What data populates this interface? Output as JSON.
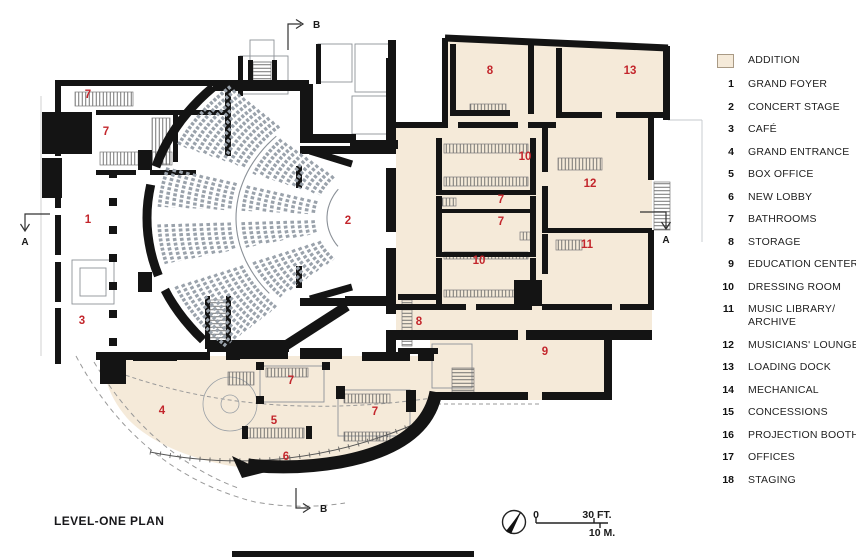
{
  "title": "LEVEL-ONE PLAN",
  "colors": {
    "addition_fill": "#f5ead9",
    "room_number_red": "#c3262c",
    "wall_black": "#141414"
  },
  "legend": {
    "addition_label": "ADDITION",
    "addition_swatch_icon": "addition-swatch",
    "items": [
      {
        "num": "1",
        "label": "GRAND FOYER"
      },
      {
        "num": "2",
        "label": "CONCERT STAGE"
      },
      {
        "num": "3",
        "label": "CAFÉ"
      },
      {
        "num": "4",
        "label": "GRAND ENTRANCE"
      },
      {
        "num": "5",
        "label": "BOX OFFICE"
      },
      {
        "num": "6",
        "label": "NEW LOBBY"
      },
      {
        "num": "7",
        "label": "BATHROOMS"
      },
      {
        "num": "8",
        "label": "STORAGE"
      },
      {
        "num": "9",
        "label": "EDUCATION CENTER"
      },
      {
        "num": "10",
        "label": "DRESSING ROOM"
      },
      {
        "num": "11",
        "label": "MUSIC LIBRARY/ ARCHIVE"
      },
      {
        "num": "12",
        "label": "MUSICIANS' LOUNGE"
      },
      {
        "num": "13",
        "label": "LOADING DOCK"
      },
      {
        "num": "14",
        "label": "MECHANICAL"
      },
      {
        "num": "15",
        "label": "CONCESSIONS"
      },
      {
        "num": "16",
        "label": "PROJECTION BOOTH"
      },
      {
        "num": "17",
        "label": "OFFICES"
      },
      {
        "num": "18",
        "label": "STAGING"
      }
    ]
  },
  "plan": {
    "sections": {
      "top": "B",
      "bottom": "B",
      "left": "A",
      "right": "A"
    },
    "scale_bar": {
      "zero": "0",
      "feet": "30 FT.",
      "meters": "10 M."
    },
    "compass_icon": "north-arrow",
    "room_numbers": [
      {
        "num": "7",
        "x": 88,
        "y": 95
      },
      {
        "num": "7",
        "x": 106,
        "y": 132
      },
      {
        "num": "1",
        "x": 88,
        "y": 220
      },
      {
        "num": "3",
        "x": 82,
        "y": 321
      },
      {
        "num": "4",
        "x": 162,
        "y": 411
      },
      {
        "num": "7",
        "x": 291,
        "y": 381
      },
      {
        "num": "5",
        "x": 274,
        "y": 421
      },
      {
        "num": "7",
        "x": 375,
        "y": 412
      },
      {
        "num": "6",
        "x": 286,
        "y": 457
      },
      {
        "num": "2",
        "x": 348,
        "y": 221
      },
      {
        "num": "8",
        "x": 490,
        "y": 71
      },
      {
        "num": "13",
        "x": 630,
        "y": 71
      },
      {
        "num": "10",
        "x": 525,
        "y": 157
      },
      {
        "num": "12",
        "x": 590,
        "y": 184
      },
      {
        "num": "7",
        "x": 501,
        "y": 200
      },
      {
        "num": "7",
        "x": 501,
        "y": 222
      },
      {
        "num": "11",
        "x": 587,
        "y": 245
      },
      {
        "num": "10",
        "x": 479,
        "y": 261
      },
      {
        "num": "8",
        "x": 419,
        "y": 322
      },
      {
        "num": "9",
        "x": 545,
        "y": 352
      }
    ]
  }
}
